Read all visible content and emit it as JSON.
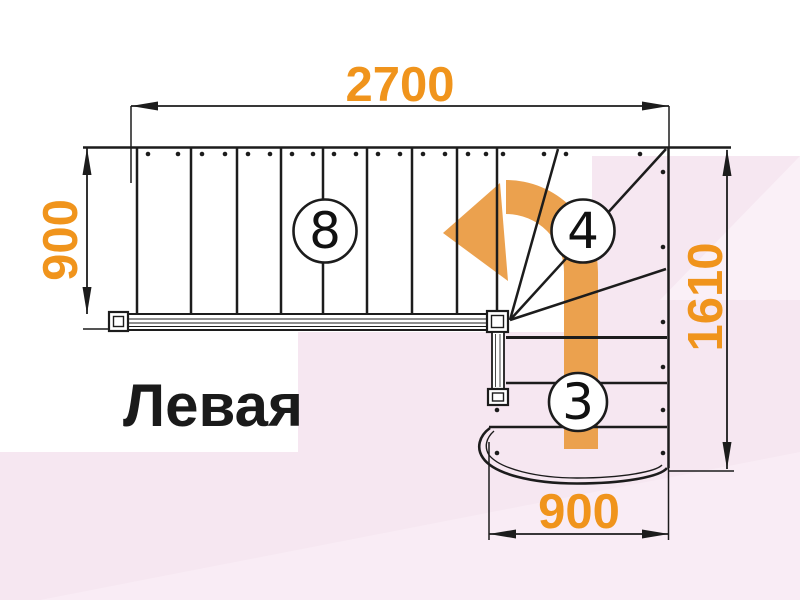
{
  "page": {
    "title_label": "Левая"
  },
  "dimensions": {
    "top_width_mm": "2700",
    "left_height_mm": "900",
    "right_height_mm": "1610",
    "bottom_width_mm": "900"
  },
  "steps": {
    "straight_flight_count": "8",
    "winder_count": "4",
    "lower_flight_count": "3"
  },
  "colors": {
    "dimension_orange": "#F0941C",
    "arrow_orange": "#EBA14E",
    "line_black": "#1C1C1C",
    "background_pink": "#F6E7F1",
    "background_pink_light": "#FAF0F7",
    "circle_fill": "#FFFFFF"
  }
}
